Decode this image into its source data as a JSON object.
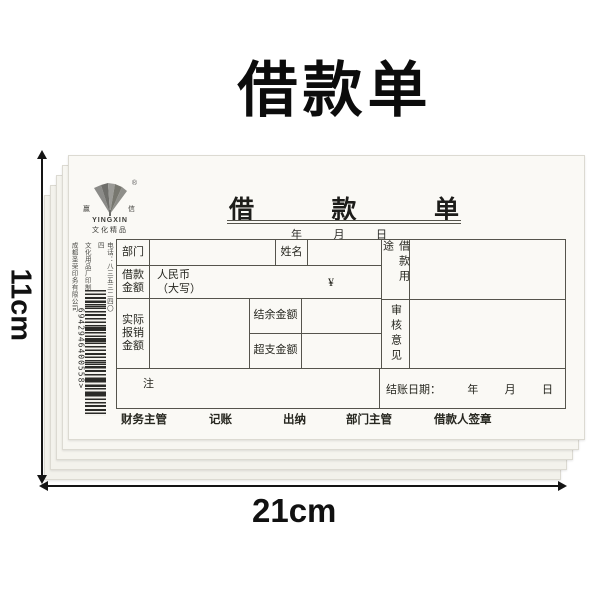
{
  "page": {
    "title": "借款单"
  },
  "dimensions": {
    "height_label": "11cm",
    "width_label": "21cm"
  },
  "brand": {
    "name": "YINGXIN",
    "tagline": "文化精品",
    "registered_mark": "®",
    "side_char_left": "赢",
    "side_char_right": "信"
  },
  "print_info": {
    "company": "成都圣荣印务有限公司",
    "producer": "文化用品厂印制",
    "phone": "电话：八三五三二四〇四"
  },
  "barcode": {
    "number": "6942946400558",
    "terminator": ">"
  },
  "form": {
    "title_chars": [
      "借",
      "款",
      "单"
    ],
    "date_line": [
      "年",
      "月",
      "日"
    ],
    "fields": {
      "department": "部门",
      "name": "姓名",
      "loan_amount_l1": "借款",
      "loan_amount_l2": "金额",
      "rmb_caps_l1": "人民币",
      "rmb_caps_l2": "（大写）",
      "currency_symbol": "¥",
      "loan_purpose": "借款用途",
      "actual_l1": "实际",
      "actual_l2": "报销",
      "actual_l3": "金额",
      "balance": "结余金额",
      "overspend": "超支金额",
      "review": "审核意见",
      "note": "注",
      "settle_date": "结账日期：",
      "year": "年",
      "month": "月",
      "day": "日"
    },
    "signatures": [
      "财务主管",
      "记账",
      "出纳",
      "部门主管",
      "借款人签章"
    ]
  },
  "colors": {
    "background": "#ffffff",
    "sheet": "#faf9f5",
    "table_line": "#55544c",
    "ink": "#26261f",
    "annotation": "#111111"
  }
}
